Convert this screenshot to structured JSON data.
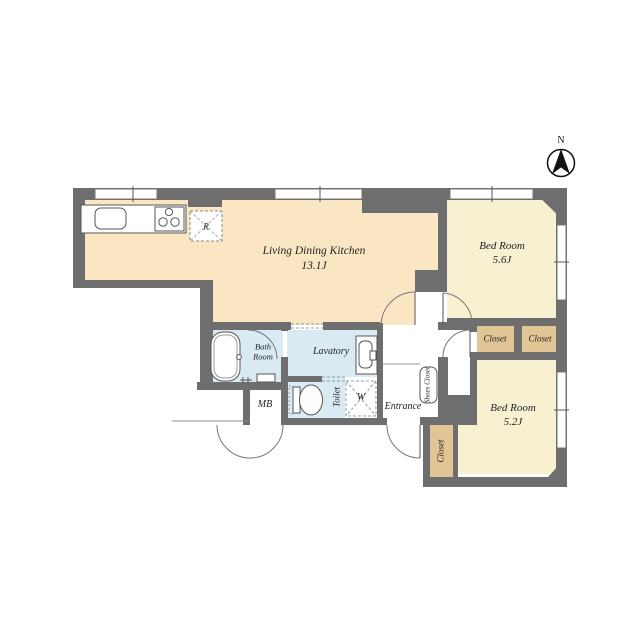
{
  "compass": {
    "north_label": "N"
  },
  "rooms": {
    "ldk": {
      "name": "Living Dining Kitchen",
      "size": "13.1J"
    },
    "bedroom_1": {
      "name": "Bed Room",
      "size": "5.6J"
    },
    "bedroom_2": {
      "name": "Bed Room",
      "size": "5.2J"
    },
    "bath": {
      "line1": "Bath",
      "line2": "Room"
    },
    "lavatory": {
      "name": "Lavatory"
    },
    "toilet": {
      "name": "Toilet"
    },
    "entrance": {
      "name": "Entrance"
    },
    "meter_box": {
      "abbr": "MB"
    }
  },
  "storage": {
    "closet_1": "Closet",
    "closet_2": "Closet",
    "closet_3": "Closet",
    "shoes_closet": "Shoes Closet"
  },
  "appliances": {
    "refrigerator_abbr": "R",
    "washer_abbr": "W"
  },
  "colors": {
    "wall": "#6e6e6e",
    "ldk_floor": "#fae6c3",
    "bedroom_floor": "#f7f1d2",
    "closet_fill": "#e2c594",
    "wet_area": "#d9eaf3",
    "fixture_line": "#555555",
    "door_arc": "#777777",
    "text": "#1f1f1f"
  }
}
